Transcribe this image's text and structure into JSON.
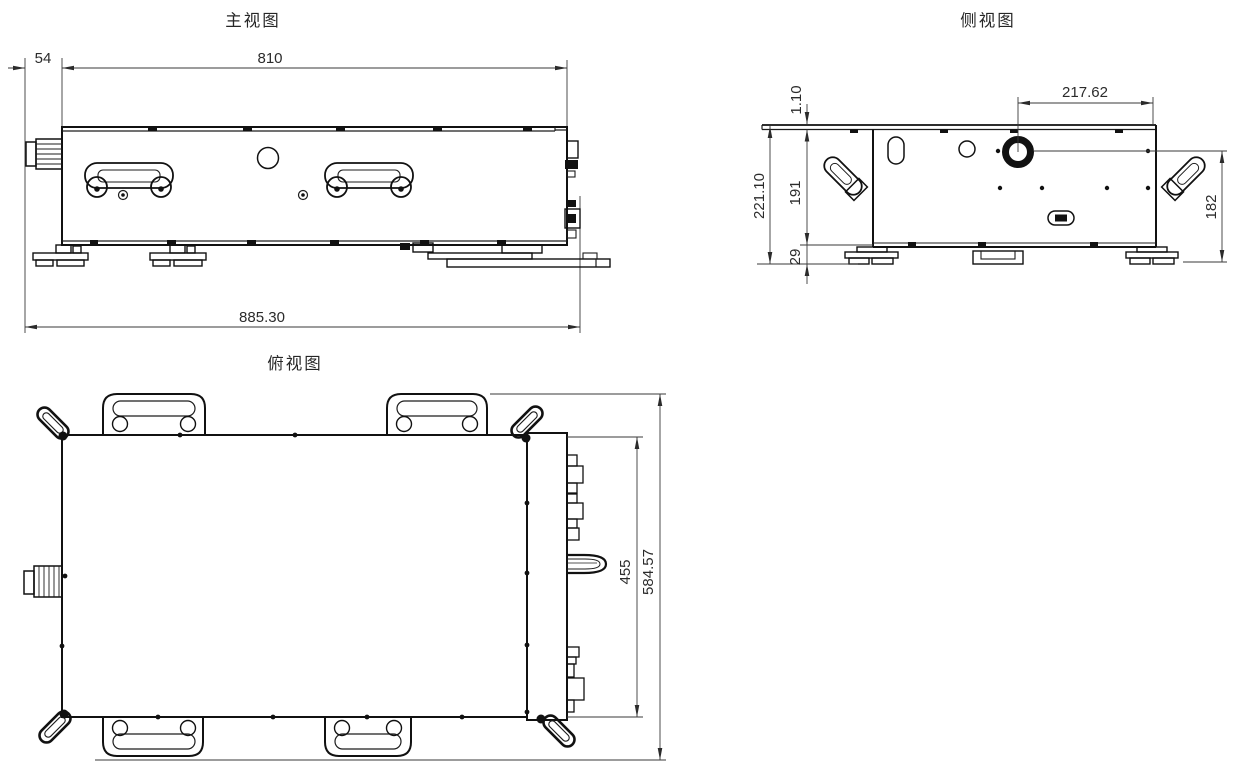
{
  "titles": {
    "front": "主视图",
    "side": "侧视图",
    "top": "俯视图"
  },
  "dims": {
    "front_left_offset": "54",
    "front_body_width": "810",
    "front_total_width": "885.30",
    "side_lid_thickness": "1.10",
    "side_total_height": "221.10",
    "side_body_height": "191",
    "side_foot_height": "29",
    "side_aperture_offset": "217.62",
    "side_aperture_height": "182",
    "top_body_depth": "455",
    "top_total_depth": "584.57"
  },
  "colors": {
    "line": "#111111",
    "dimension": "#3a3a3a",
    "background": "#ffffff"
  }
}
